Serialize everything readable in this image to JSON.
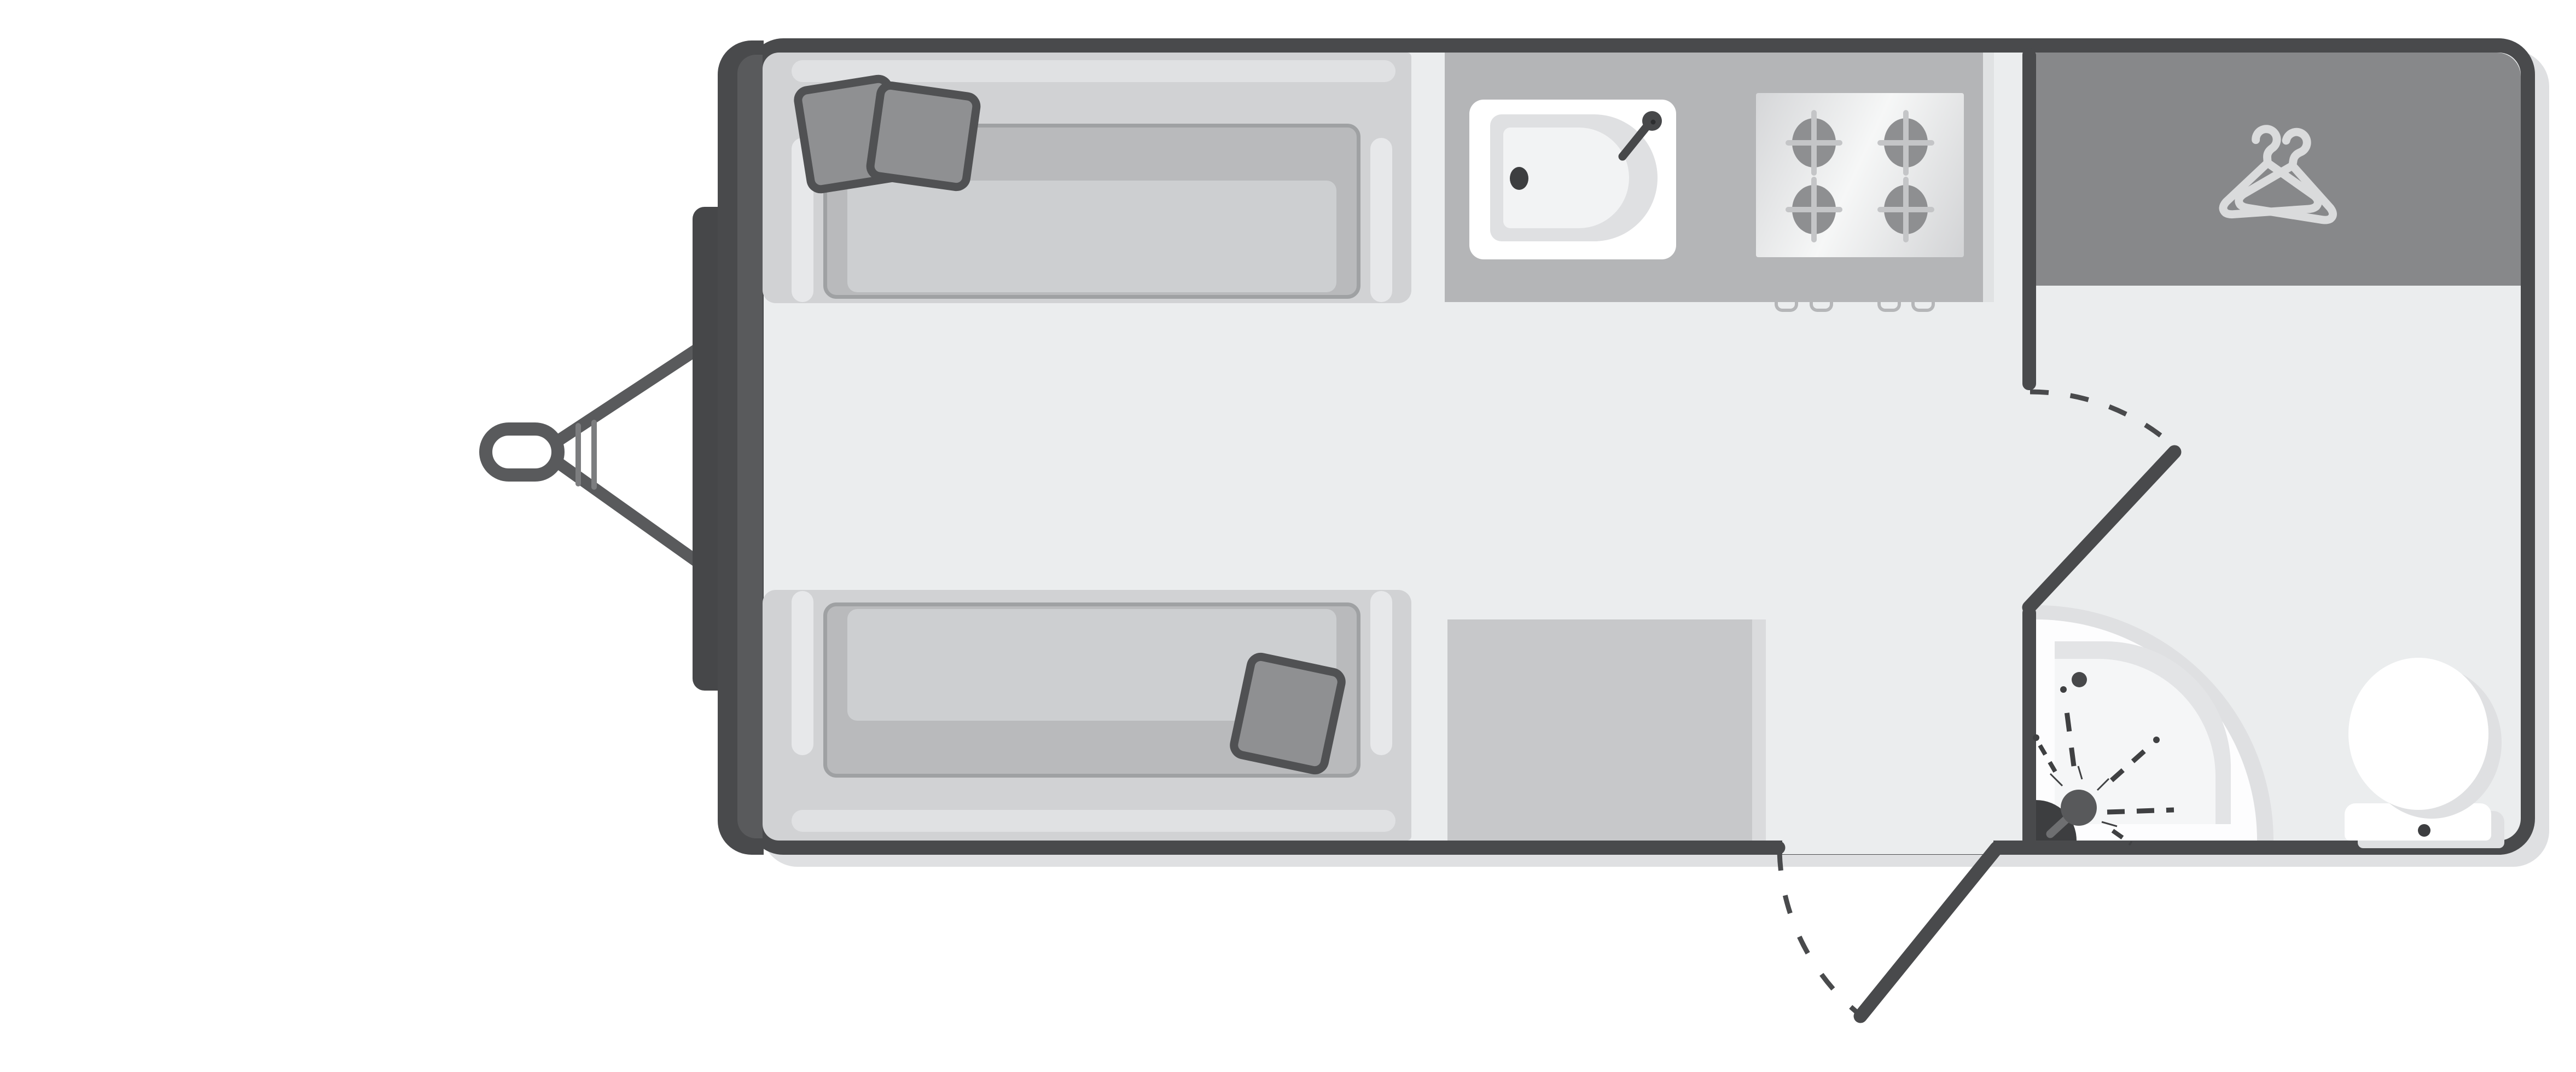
{
  "diagram_type": "caravan-floorplan-top-view",
  "labels": {
    "plan": "Caravan floor plan, top-down view",
    "hitch": "Tow hitch and A-frame drawbar",
    "gas_locker": "Front gas locker",
    "front_sofa": "Front offside sofa bed with two cushions and pillows",
    "rear_sofa": "Front nearside sofa bed with cushion and pillow",
    "kitchen": "Kitchen worktop with sink and four-burner hob",
    "sink": "Kitchen sink with tap",
    "hob": "Four-burner gas hob",
    "wardrobe": "Wardrobe",
    "chest": "Chest of drawers / kitchen unit",
    "washroom": "Rear washroom",
    "shower": "Corner shower with mixer",
    "toilet": "Toilet with cistern",
    "entry_door": "Entry door with swing arc",
    "washroom_door": "Washroom door with swing arc"
  },
  "icons": [
    {
      "name": "clothes-hangers-icon",
      "meaning": "wardrobe storage"
    },
    {
      "name": "burner-icon",
      "meaning": "gas hob ring",
      "count": 4
    },
    {
      "name": "shower-spray-icon",
      "meaning": "shower head spray"
    },
    {
      "name": "door-swing-arc-icon",
      "meaning": "door opening direction",
      "count": 2
    }
  ],
  "palette": {
    "page-bg": "#ffffff",
    "wall": "#494a4c",
    "front-wall": "#595a5c",
    "floor": "#ebedee",
    "shadow": "#dfe0e2",
    "locker": "#464749",
    "hitch": "#595a5c",
    "hitch-tick": "#7c7d7f",
    "sofa-base": "#d1d2d4",
    "sofa-rail": "#e0e1e3",
    "cushion-frame": "#9fa1a3",
    "cushion": "#b9babc",
    "cushion-inset": "#cdcfd1",
    "armrest": "#e7e8ea",
    "pillow": "#8f9092",
    "pillow-edge": "#505153",
    "counter": "#b4b5b7",
    "counter-edge": "#e0e2e3",
    "sink-white": "#ffffff",
    "basin-rim": "#dfe0e2",
    "basin": "#f2f3f4",
    "fixture-dark": "#3d3e40",
    "faucet": "#47484a",
    "hob-light": "#f6f7f7",
    "hob-dark": "#d5d6d8",
    "burner": "#8e8f91",
    "burner-spoke": "#c4c5c7",
    "knob": "#b5b6b8",
    "wardrobe": "#87888a",
    "hanger": "#dadbdc",
    "chest": "#c7c8ca",
    "chest-edge": "#dadbdd",
    "shower-white": "#fdfdfe",
    "tray-rim": "#e3e4e6",
    "tray": "#f5f6f7",
    "mixer": "#58595b",
    "mixer-stem": "#6e6f71",
    "spray": "#3f4042",
    "toilet-white": "#ffffff"
  }
}
